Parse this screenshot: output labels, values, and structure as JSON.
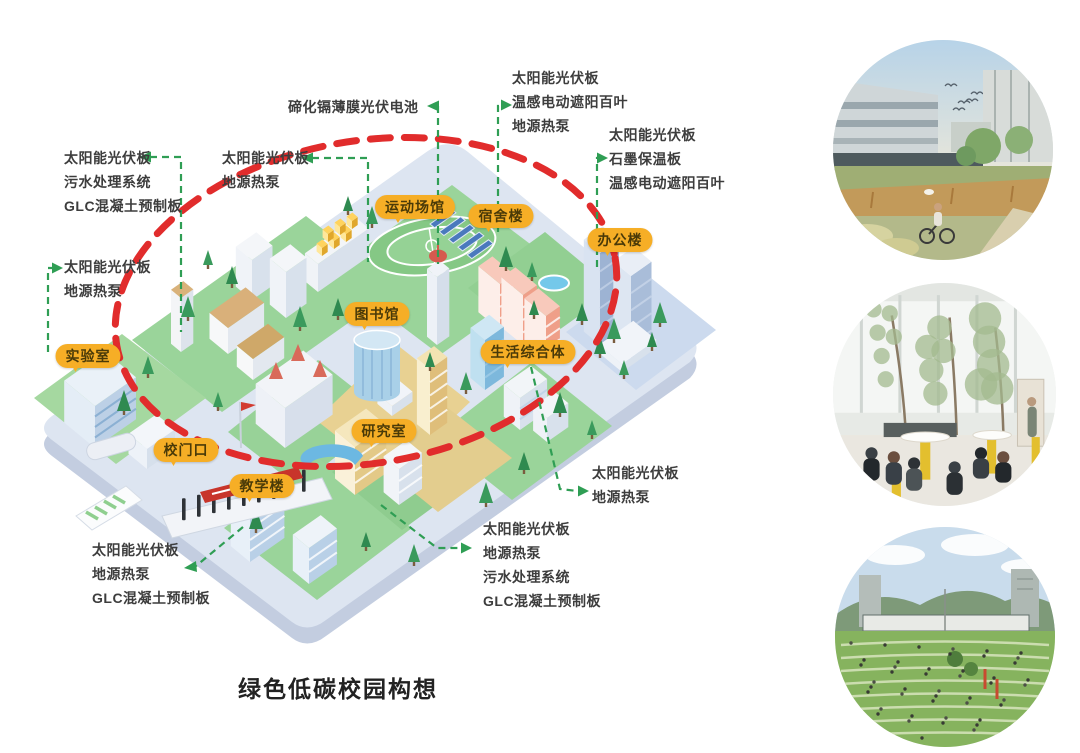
{
  "page": {
    "title": "绿色低碳校园构想"
  },
  "colors": {
    "bubble_bg": "#F6AE26",
    "bubble_text": "#4a3a08",
    "leader_green": "#2F9E54",
    "ellipse_red": "#E12C2C",
    "annotation_text": "#3d3d3d",
    "plate": "#dde5f1",
    "lawn": "#9ad49a"
  },
  "map": {
    "buildings": [
      {
        "id": "sports-venue",
        "label": "运动场馆"
      },
      {
        "id": "dormitory",
        "label": "宿舍楼"
      },
      {
        "id": "office-building",
        "label": "办公楼"
      },
      {
        "id": "library",
        "label": "图书馆"
      },
      {
        "id": "life-complex",
        "label": "生活综合体"
      },
      {
        "id": "laboratory",
        "label": "实验室"
      },
      {
        "id": "school-gate",
        "label": "校门口"
      },
      {
        "id": "teaching-building",
        "label": "教学楼"
      },
      {
        "id": "research-lab",
        "label": "研究室"
      }
    ],
    "annotations": [
      {
        "id": "top-left",
        "text": "太阳能光伏板\n污水处理系统\nGLC混凝土预制板"
      },
      {
        "id": "left",
        "text": "太阳能光伏板\n地源热泵"
      },
      {
        "id": "mid-left",
        "text": "太阳能光伏板\n地源热泵"
      },
      {
        "id": "top-center",
        "text": "碲化镉薄膜光伏电池"
      },
      {
        "id": "top-right",
        "text": "太阳能光伏板\n温感电动遮阳百叶\n地源热泵"
      },
      {
        "id": "right",
        "text": "太阳能光伏板\n石墨保温板\n温感电动遮阳百叶"
      },
      {
        "id": "mid-right",
        "text": "太阳能光伏板\n地源热泵"
      },
      {
        "id": "bottom-center",
        "text": "太阳能光伏板\n地源热泵\n污水处理系统\nGLC混凝土预制板"
      },
      {
        "id": "bottom-left",
        "text": "太阳能光伏板\n地源热泵\nGLC混凝土预制板"
      }
    ]
  },
  "photos": [
    {
      "name": "campus-wetland-cyclist"
    },
    {
      "name": "atrium-cafe-trees"
    },
    {
      "name": "terraced-lawn-gathering"
    }
  ]
}
